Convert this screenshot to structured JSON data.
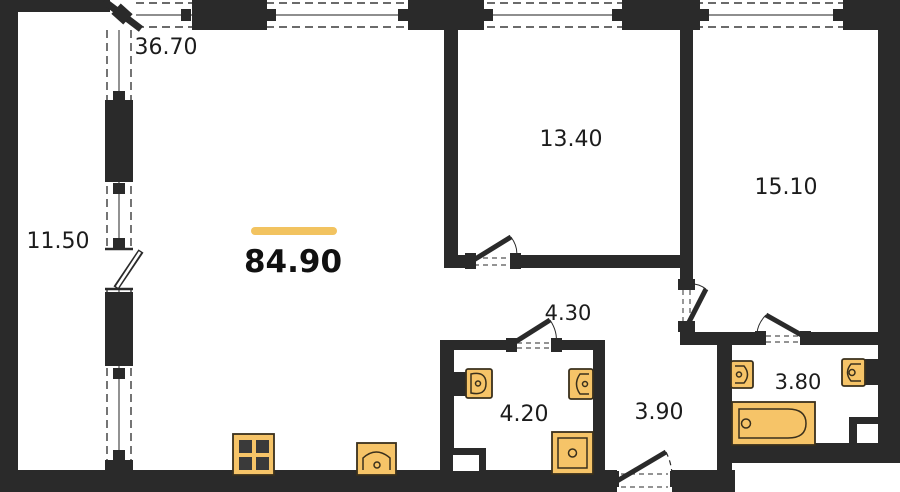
{
  "plan": {
    "total_area": {
      "value": "84.90"
    },
    "rooms": [
      {
        "id": "living-room",
        "area": "36.70"
      },
      {
        "id": "balcony",
        "area": "11.50"
      },
      {
        "id": "bedroom-1",
        "area": "13.40"
      },
      {
        "id": "bedroom-2",
        "area": "15.10"
      },
      {
        "id": "hall",
        "area": "4.30"
      },
      {
        "id": "bathroom",
        "area": "4.20"
      },
      {
        "id": "corridor",
        "area": "3.90"
      },
      {
        "id": "ensuite-bathroom",
        "area": "3.80"
      }
    ],
    "fixtures": [
      "stove",
      "kitchen-sink",
      "toilet",
      "washbasin",
      "shower",
      "bathtub"
    ],
    "colors": {
      "wall": "#2a2a2a",
      "fixture_fill": "#F6C468",
      "fixture_stroke": "#3a301c",
      "accent": "#F2C360",
      "text": "#1c1c1c"
    }
  }
}
